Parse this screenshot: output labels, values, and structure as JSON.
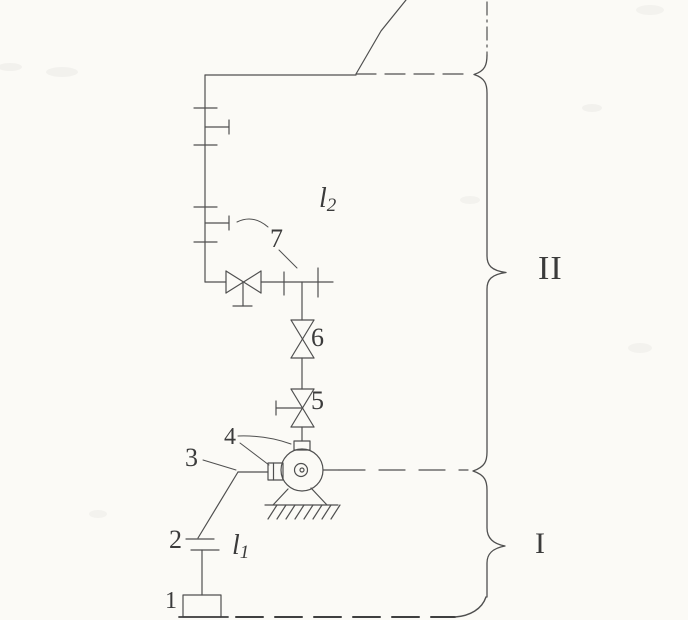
{
  "diagram": {
    "colors": {
      "background": "#fbfaf6",
      "line": "#4f4f4f",
      "heavy_line": "#3f3f3f",
      "text": "#3b3b3b"
    },
    "part_labels": {
      "p1": "1",
      "p2": "2",
      "p3": "3",
      "p4": "4",
      "p5": "5",
      "p6": "6",
      "p7": "7"
    },
    "length_labels": {
      "l1": {
        "letter": "l",
        "sub": "1"
      },
      "l2": {
        "letter": "l",
        "sub": "2"
      }
    },
    "section_labels": {
      "section_I": "I",
      "section_II": "II"
    }
  }
}
